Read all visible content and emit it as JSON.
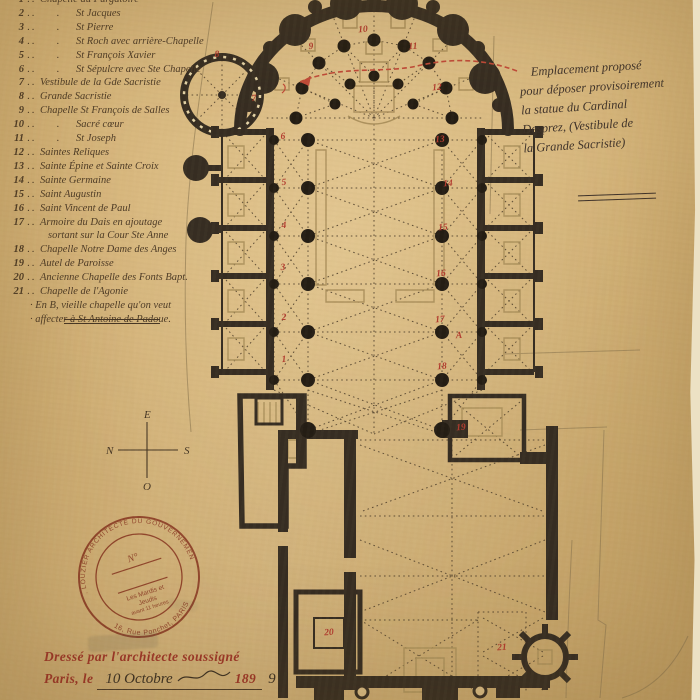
{
  "document_kind": "Plan d'architecte — cathédrale (relevé manuscrit)",
  "colors": {
    "paper": "#d7b77c",
    "ink": "#3a2f22",
    "wall": "#362d22",
    "red_annotation": "#b23b2e",
    "stamp": "#a84f46",
    "print_red": "#9c3527"
  },
  "legend": {
    "items": [
      {
        "num": "1",
        "label": "Chapelle du Purgatoire",
        "ditto": false
      },
      {
        "num": "2",
        "label": "St Jacques",
        "ditto": true
      },
      {
        "num": "3",
        "label": "St Pierre",
        "ditto": true
      },
      {
        "num": "4",
        "label": "St Roch avec arrière-Chapelle",
        "ditto": true
      },
      {
        "num": "5",
        "label": "St François Xavier",
        "ditto": true
      },
      {
        "num": "6",
        "label": "St Sépulcre avec Ste Chapelle",
        "ditto": true
      },
      {
        "num": "7",
        "label": "Vestibule de la Gde Sacristie",
        "ditto": false
      },
      {
        "num": "8",
        "label": "Grande Sacristie",
        "ditto": false
      },
      {
        "num": "9",
        "label": "Chapelle St François de Salles",
        "ditto": false
      },
      {
        "num": "10",
        "label": "Sacré cœur",
        "ditto": true
      },
      {
        "num": "11",
        "label": "St Joseph",
        "ditto": true
      },
      {
        "num": "12",
        "label": "Saintes Reliques",
        "ditto": false
      },
      {
        "num": "13",
        "label": "Sainte Épine et Sainte Croix",
        "ditto": false
      },
      {
        "num": "14",
        "label": "Sainte Germaine",
        "ditto": false
      },
      {
        "num": "15",
        "label": "Saint Augustin",
        "ditto": false
      },
      {
        "num": "16",
        "label": "Saint Vincent de Paul",
        "ditto": false
      },
      {
        "num": "17",
        "label": "Armoire du Dais en ajoutage",
        "label2": "sortant sur la Cour Ste Anne",
        "ditto": false
      },
      {
        "num": "18",
        "label": "Chapelle Notre Dame des Anges",
        "ditto": false
      },
      {
        "num": "19",
        "label": "Autel de Paroisse",
        "ditto": false
      },
      {
        "num": "20",
        "label": "Ancienne Chapelle des Fonts Bapt.",
        "ditto": false
      },
      {
        "num": "21",
        "label": "Chapelle de l'Agonie",
        "ditto": false
      }
    ],
    "footnote": [
      "En B, vieille chapelle qu'on veut",
      "affecter à St Antoine de Padoue."
    ]
  },
  "note": {
    "lines": [
      "Emplacement proposé",
      "pour déposer provisoirement",
      "la statue du Cardinal",
      "Desprez, (Vestibule de",
      "la Grande Sacristie)"
    ]
  },
  "compass": {
    "top": "E",
    "left": "N",
    "right": "S",
    "bottom": "O"
  },
  "stamp": {
    "arc_top": "A. LOUZIER ARCHITECTE DU GOUVERNEMENT",
    "arc_bottom": "16, Rue Ponchet, PARIS",
    "no_label": "N°",
    "inner_lines": [
      "Les Mardis et",
      "Jeudis",
      "avant 11 heures"
    ]
  },
  "footer": {
    "printed_line": "Dressé par l'architecte soussigné",
    "prefix": "Paris, le",
    "date_handwritten": "10 Octobre",
    "year_printed": "189",
    "year_handwritten": "9"
  },
  "plan": {
    "annotations": [
      {
        "t": "1",
        "x": 284,
        "y": 360
      },
      {
        "t": "2",
        "x": 284,
        "y": 318
      },
      {
        "t": "3",
        "x": 283,
        "y": 268
      },
      {
        "t": "4",
        "x": 284,
        "y": 226
      },
      {
        "t": "5",
        "x": 284,
        "y": 183
      },
      {
        "t": "6",
        "x": 283,
        "y": 137
      },
      {
        "t": "7",
        "x": 254,
        "y": 99
      },
      {
        "t": "8",
        "x": 217,
        "y": 55
      },
      {
        "t": "9",
        "x": 311,
        "y": 47
      },
      {
        "t": "10",
        "x": 363,
        "y": 30
      },
      {
        "t": "11",
        "x": 413,
        "y": 47
      },
      {
        "t": "12",
        "x": 437,
        "y": 88
      },
      {
        "t": "13",
        "x": 440,
        "y": 140
      },
      {
        "t": "14",
        "x": 448,
        "y": 184
      },
      {
        "t": "15",
        "x": 443,
        "y": 228
      },
      {
        "t": "16",
        "x": 441,
        "y": 274
      },
      {
        "t": "17",
        "x": 440,
        "y": 320
      },
      {
        "t": "18",
        "x": 442,
        "y": 367
      },
      {
        "t": "19",
        "x": 461,
        "y": 428
      },
      {
        "t": "20",
        "x": 329,
        "y": 633
      },
      {
        "t": "21",
        "x": 502,
        "y": 648
      },
      {
        "t": "A",
        "x": 459,
        "y": 336
      }
    ]
  }
}
